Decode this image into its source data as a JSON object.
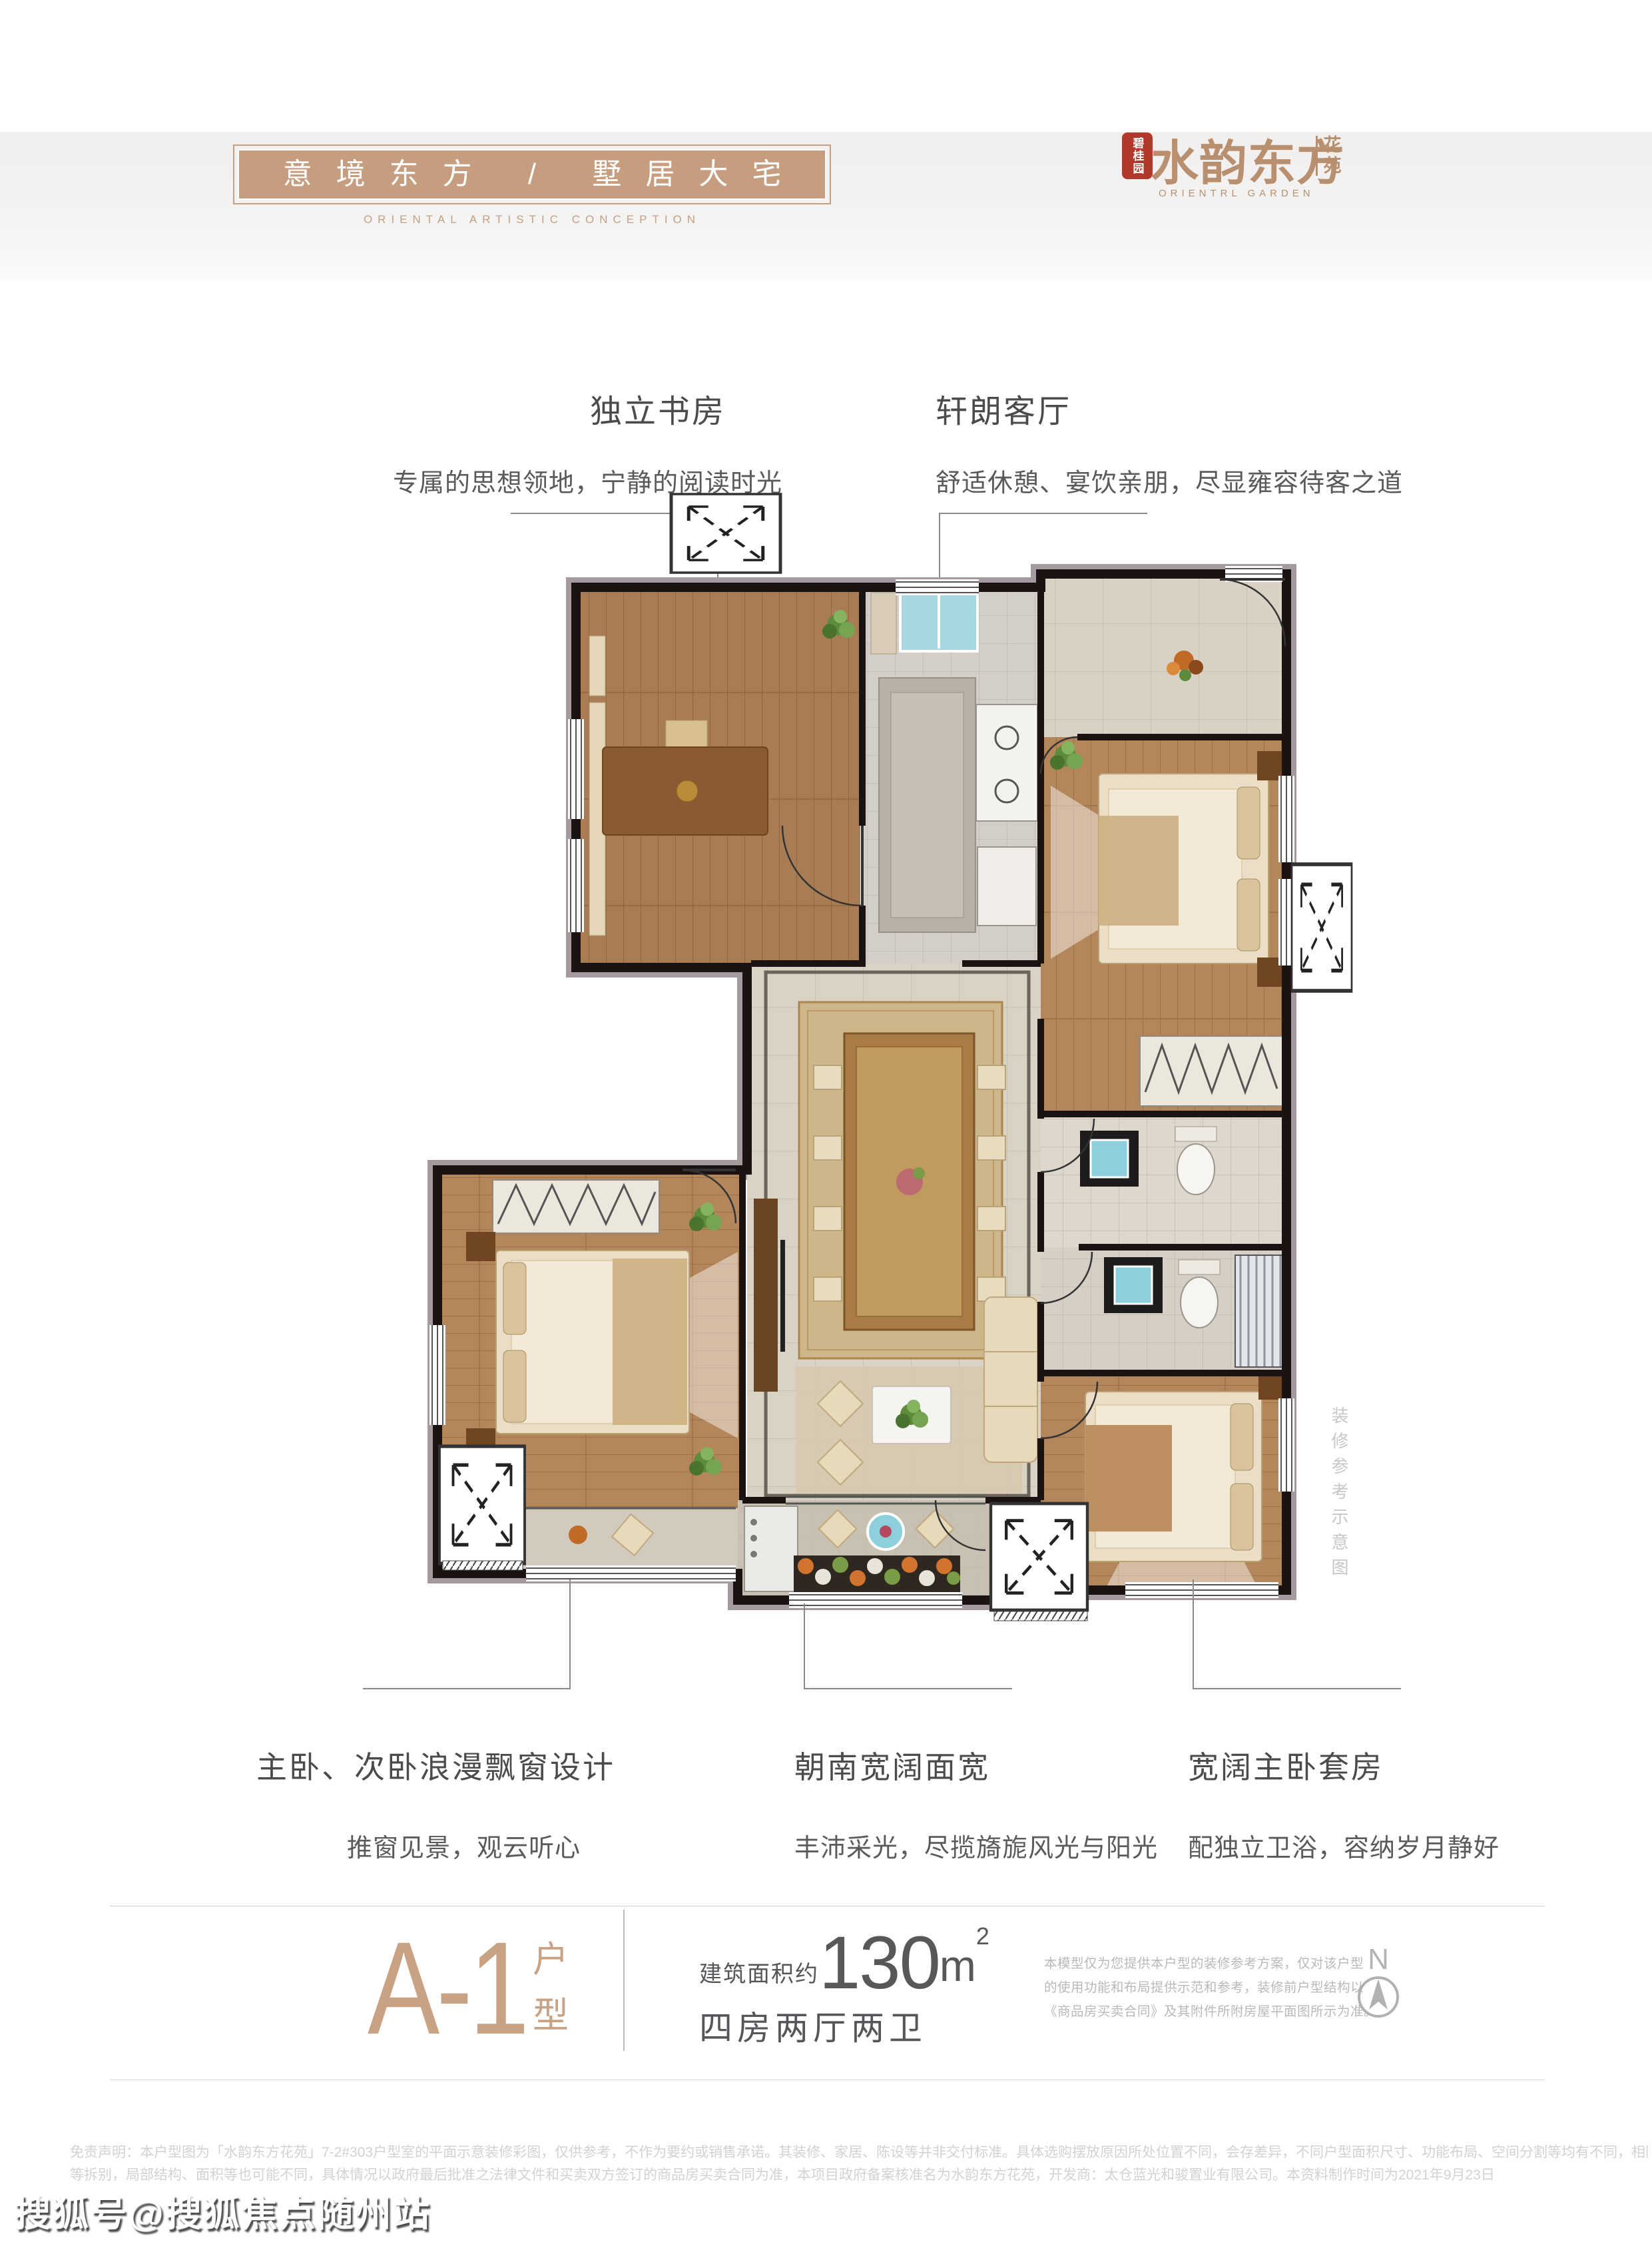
{
  "header": {
    "banner": {
      "title": "意境东方 / 墅居大宅",
      "subtitle": "ORIENTAL ARTISTIC CONCEPTION",
      "bg_color": "#c79d80"
    },
    "logo": {
      "seal_text": "碧桂园",
      "seal_color": "#b0392b",
      "name": "水韵东方",
      "suffix": "花苑",
      "subtitle": "ORIENTRL GARDEN",
      "color": "#b9906f"
    }
  },
  "callouts": {
    "top": [
      {
        "title": "独立书房",
        "desc": "专属的思想领地，宁静的阅读时光"
      },
      {
        "title": "轩朗客厅",
        "desc": "舒适休憩、宴饮亲朋，尽显雍容待客之道"
      }
    ],
    "bottom": [
      {
        "title": "主卧、次卧浪漫飘窗设计",
        "desc": "推窗见景，观云听心"
      },
      {
        "title": "朝南宽阔面宽",
        "desc": "丰沛采光，尽揽旖旎风光与阳光"
      },
      {
        "title": "宽阔主卧套房",
        "desc": "配独立卫浴，容纳岁月静好"
      }
    ]
  },
  "plan": {
    "side_note_vertical": "装修参考示意图",
    "wall_color": "#1a1311",
    "wood_color": "#a87c54",
    "tile_color": "#d9d2c5"
  },
  "info": {
    "unit_code": "A-1",
    "unit_suffix_chars": [
      "户",
      "型"
    ],
    "area_label": "建筑面积约",
    "area_value": "130",
    "area_unit": "m",
    "area_sup": "2",
    "layout": "四房两厅两卫",
    "note_lines": [
      "本模型仅为您提供本户型的装修参考方案，仅对该户型",
      "的使用功能和布局提供示范和参考，装修前户型结构以",
      "《商品房买卖合同》及其附件所附房屋平面图所示为准。"
    ],
    "compass_label": "N"
  },
  "footer": {
    "disclaimer_line1": "免责声明：本户型图为「水韵东方花苑」7-2#303户型室的平面示意装修彩图，仅供参考，不作为要约或销售承诺。其装修、家居、陈设等并非交付标准。具体选购摆放原因所处位置不同，会存差异，不同户型面积尺寸、功能布局、空间分割等均有不同，相同户型因标准层与非标准层、楼栋、楼层、单元",
    "disclaimer_line2": "等拆别，局部结构、面积等也可能不同，具体情况以政府最后批准之法律文件和买卖双方签订的商品房买卖合同为准，本项目政府备案核准名为水韵东方花苑，开发商：太仓蓝光和骏置业有限公司。本资料制作时间为2021年9月23日"
  },
  "watermark": "搜狐号@搜狐焦点随州站"
}
